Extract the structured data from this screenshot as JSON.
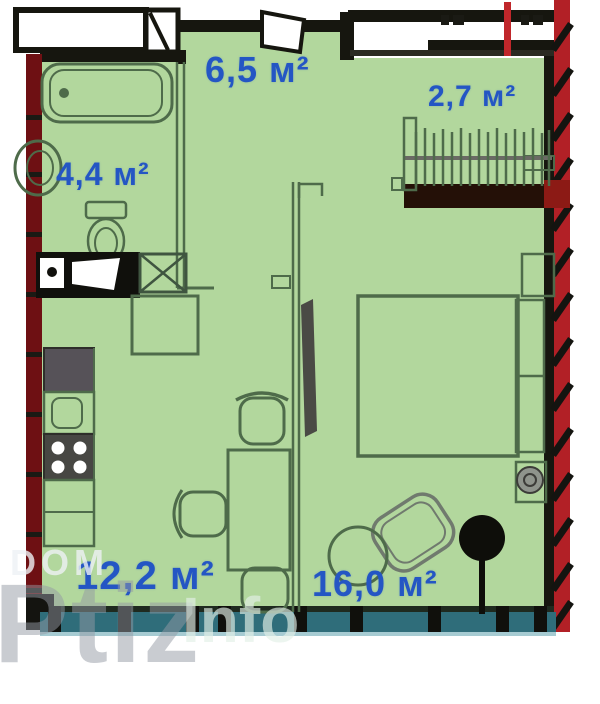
{
  "plan": {
    "type": "apartment-floor-plan",
    "rooms": {
      "hall": {
        "area": "6,5 м²"
      },
      "closet": {
        "area": "2,7 м²"
      },
      "bathroom": {
        "area": "4,4 м²"
      },
      "kitchen_living": {
        "area": "12,2 м²"
      },
      "bedroom": {
        "area": "16,0 м²"
      }
    },
    "watermark": {
      "line1": "DOM",
      "line2": "Ptiz",
      "line3": "Info"
    },
    "colors": {
      "floor_green": "#b2d79d",
      "wall_black": "#16160f",
      "furniture_line": "#4e6b4a",
      "load_wall_red_left": "#6e1013",
      "boundary_red": "#b22026",
      "window_teal": "#2f6d7a",
      "area_label_blue": "#2456c4",
      "watermark_gray": "#949aa4"
    }
  }
}
